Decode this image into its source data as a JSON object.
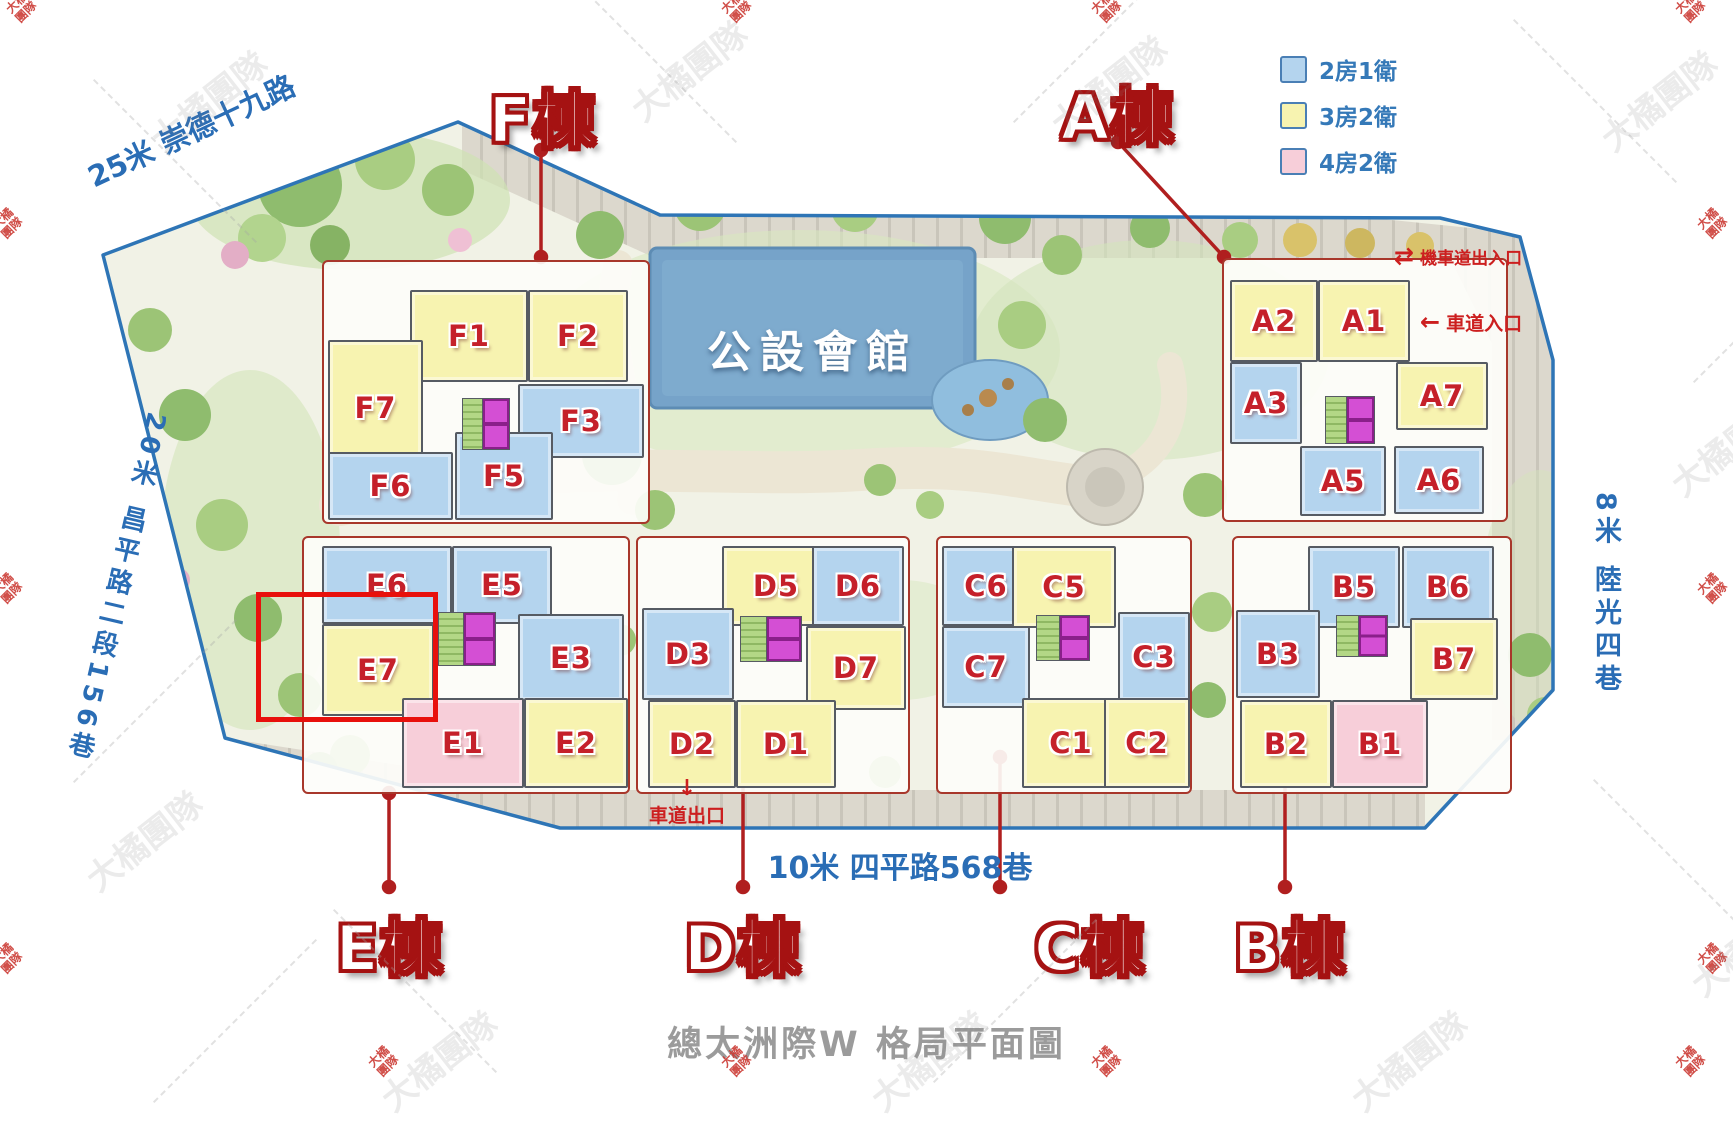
{
  "title": "總太洲際W 格局平面圖",
  "watermark_text": "大橘團隊",
  "clubhouse": {
    "label": "公設會館"
  },
  "legend": {
    "items": [
      {
        "label": "2房1衛",
        "color": "#b4d4ee"
      },
      {
        "label": "3房2衛",
        "color": "#f7f3b0"
      },
      {
        "label": "4房2衛",
        "color": "#f7ced9"
      }
    ]
  },
  "roads": {
    "top_left": "25米 崇德十九路",
    "left": "20米 昌平路二段156巷",
    "bottom": "10米 四平路568巷",
    "right": "8米 陸光四巷"
  },
  "entrances": {
    "moto_label": "機車道出入口",
    "moto_icon": "⇄",
    "car_in_label": "車道入口",
    "car_in_icon": "←",
    "car_out_label": "車道出口",
    "car_out_icon": "↓"
  },
  "selection": {
    "unit": "E7"
  },
  "buildings": [
    {
      "name": "F棟",
      "units": [
        {
          "id": "F1",
          "type": "3房2衛"
        },
        {
          "id": "F2",
          "type": "3房2衛"
        },
        {
          "id": "F7",
          "type": "3房2衛"
        },
        {
          "id": "F3",
          "type": "2房1衛"
        },
        {
          "id": "F6",
          "type": "2房1衛"
        },
        {
          "id": "F5",
          "type": "2房1衛"
        }
      ]
    },
    {
      "name": "A棟",
      "units": [
        {
          "id": "A2",
          "type": "3房2衛"
        },
        {
          "id": "A1",
          "type": "3房2衛"
        },
        {
          "id": "A3",
          "type": "2房1衛"
        },
        {
          "id": "A7",
          "type": "3房2衛"
        },
        {
          "id": "A5",
          "type": "2房1衛"
        },
        {
          "id": "A6",
          "type": "2房1衛"
        }
      ]
    },
    {
      "name": "E棟",
      "units": [
        {
          "id": "E6",
          "type": "2房1衛"
        },
        {
          "id": "E5",
          "type": "2房1衛"
        },
        {
          "id": "E7",
          "type": "3房2衛"
        },
        {
          "id": "E3",
          "type": "2房1衛"
        },
        {
          "id": "E1",
          "type": "4房2衛"
        },
        {
          "id": "E2",
          "type": "3房2衛"
        }
      ]
    },
    {
      "name": "D棟",
      "units": [
        {
          "id": "D5",
          "type": "3房2衛"
        },
        {
          "id": "D6",
          "type": "2房1衛"
        },
        {
          "id": "D3",
          "type": "2房1衛"
        },
        {
          "id": "D7",
          "type": "3房2衛"
        },
        {
          "id": "D2",
          "type": "3房2衛"
        },
        {
          "id": "D1",
          "type": "3房2衛"
        }
      ]
    },
    {
      "name": "C棟",
      "units": [
        {
          "id": "C6",
          "type": "2房1衛"
        },
        {
          "id": "C5",
          "type": "3房2衛"
        },
        {
          "id": "C7",
          "type": "2房1衛"
        },
        {
          "id": "C3",
          "type": "2房1衛"
        },
        {
          "id": "C1",
          "type": "3房2衛"
        },
        {
          "id": "C2",
          "type": "3房2衛"
        }
      ]
    },
    {
      "name": "B棟",
      "units": [
        {
          "id": "B5",
          "type": "2房1衛"
        },
        {
          "id": "B6",
          "type": "2房1衛"
        },
        {
          "id": "B3",
          "type": "2房1衛"
        },
        {
          "id": "B7",
          "type": "3房2衛"
        },
        {
          "id": "B2",
          "type": "3房2衛"
        },
        {
          "id": "B1",
          "type": "4房2衛"
        }
      ]
    }
  ]
}
